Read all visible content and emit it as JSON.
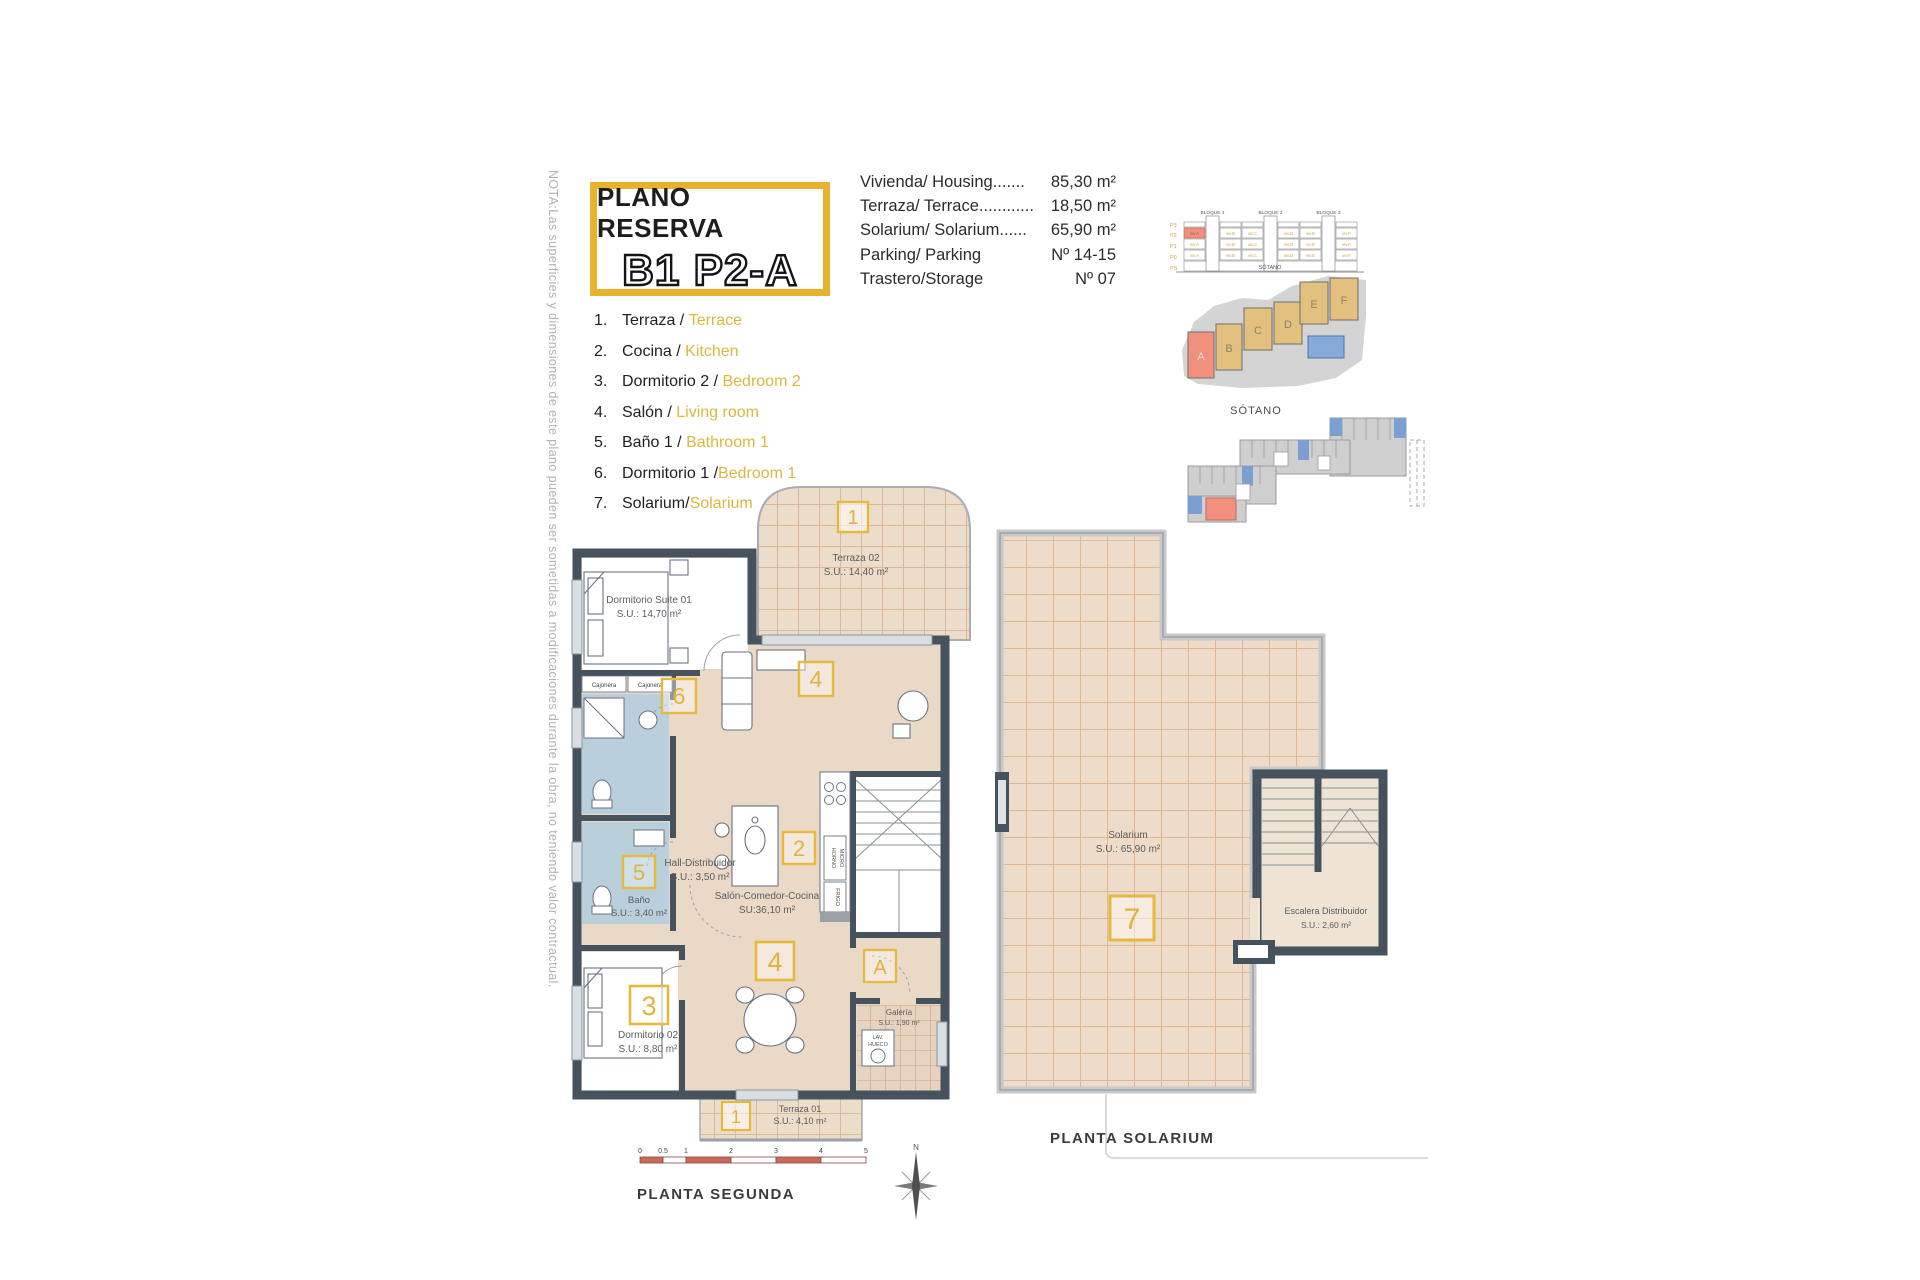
{
  "note": "NOTA:Las superficies y dimensiones de este plano pueden ser sometidas a modificaciones durante la obra, no teniendo valor contractual.",
  "title": {
    "top": "PLANO RESERVA",
    "main": "B1 P2-A"
  },
  "specs": [
    {
      "label": "Vivienda/ Housing.......",
      "value": "85,30 m²"
    },
    {
      "label": "Terraza/ Terrace............",
      "value": "18,50 m²"
    },
    {
      "label": "Solarium/ Solarium......",
      "value": "65,90 m²"
    },
    {
      "label": "Parking/ Parking",
      "value": "Nº 14-15"
    },
    {
      "label": "Trastero/Storage",
      "value": "Nº 07"
    }
  ],
  "legend": [
    {
      "num": "1.",
      "es": "Terraza",
      "sep": " / ",
      "en": "Terrace"
    },
    {
      "num": "2.",
      "es": "Cocina",
      "sep": " / ",
      "en": "Kitchen"
    },
    {
      "num": "3.",
      "es": "Dormitorio 2",
      "sep": " / ",
      "en": "Bedroom 2"
    },
    {
      "num": "4.",
      "es": "Salón",
      "sep": " / ",
      "en": "Living room"
    },
    {
      "num": "5.",
      "es": "Baño 1",
      "sep": " / ",
      "en": "Bathroom 1"
    },
    {
      "num": "6.",
      "es": "Dormitorio 1",
      "sep": " /",
      "en": "Bedroom 1"
    },
    {
      "num": "7.",
      "es": "Solarium",
      "sep": "/",
      "en": "Solarium"
    }
  ],
  "elevation": {
    "blocks": [
      "BLOQUE 1",
      "BLOQUE 2",
      "BLOQUE 3"
    ],
    "floors": [
      "P3",
      "P2",
      "P1",
      "P0",
      "PS"
    ],
    "units": [
      "viv.A",
      "viv.B",
      "viv.C",
      "viv.D",
      "viv.E",
      "viv.F"
    ],
    "basement": "SÓTANO"
  },
  "site": {
    "labels": [
      "A",
      "B",
      "C",
      "D",
      "E",
      "F"
    ]
  },
  "sotano": {
    "label": "SÓTANO"
  },
  "plan": {
    "terraza02": {
      "name": "Terraza 02",
      "area": "S.U.: 14,40 m²"
    },
    "suite": {
      "name": "Dormitorio Suite 01",
      "area": "S.U.: 14,70 m²"
    },
    "hall": {
      "name": "Hall-Distribuidor",
      "area": "S.U.: 3,50 m²"
    },
    "bano": {
      "name": "Baño",
      "area": "S.U.: 3,40 m²"
    },
    "salon": {
      "name": "Salón-Comedor-Cocina",
      "area": "SU:36,10 m²"
    },
    "dorm02": {
      "name": "Dormitorio 02",
      "area": "S.U.: 8,80 m²"
    },
    "terraza01": {
      "name": "Terraza 01",
      "area": "S.U.: 4,10 m²"
    },
    "galeria": {
      "name": "Galería",
      "area": "S.U.: 1,90 m²"
    },
    "cajonera": "Cajonera",
    "horno": "HORNO",
    "micro": "MICRO",
    "frigo": "FRIGO",
    "lav1": "LAV.",
    "lav2": "HUECO",
    "markers": {
      "one": "1",
      "two": "2",
      "three": "3",
      "four": "4",
      "five": "5",
      "six": "6",
      "seven": "7",
      "a": "A"
    }
  },
  "solarium": {
    "name": "Solarium",
    "area": "S.U.: 65,90 m²",
    "esc_name": "Escalera Distribuidor",
    "esc_area": "S.U.: 2,60 m²"
  },
  "captions": {
    "segunda": "PLANTA SEGUNDA",
    "solarium": "PLANTA SOLARIUM"
  },
  "scale": {
    "ticks": [
      "0",
      "0.5",
      "1",
      "2",
      "3",
      "4",
      "5"
    ]
  },
  "compass": {
    "n": "N"
  },
  "colors": {
    "accent_gold": "#e8b22c",
    "legend_yellow": "#d9b83e",
    "wall": "#47525f",
    "floor_beige": "#ecdcca",
    "bath_blue": "#b9cfdb",
    "highlight_red": "#f2907e",
    "block_tan": "#e3c07e",
    "pool_blue": "#85abdb",
    "scale_red": "#cd6a5c"
  }
}
